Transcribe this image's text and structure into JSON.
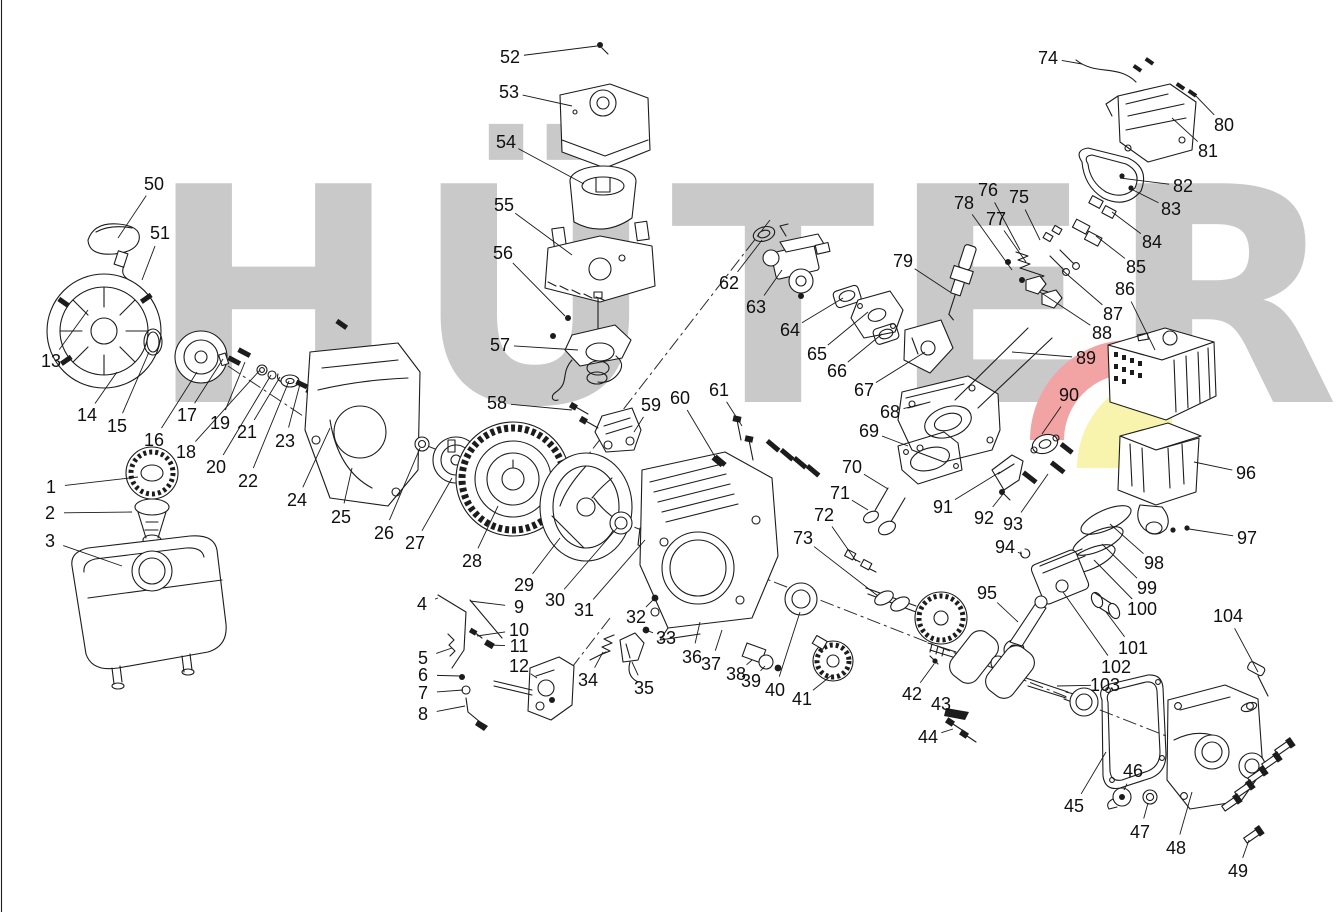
{
  "watermark": {
    "text": "HÜTER"
  },
  "colors": {
    "watermark_gray": "#c9c9c9",
    "logo_red": "#f2a3a3",
    "logo_yellow": "#f8f4ae",
    "line_ink": "#1c1c1c",
    "background": "#ffffff"
  },
  "callouts": [
    {
      "n": "1",
      "x": 51,
      "y": 487,
      "tx": 138,
      "ty": 477
    },
    {
      "n": "2",
      "x": 50,
      "y": 513,
      "tx": 132,
      "ty": 512
    },
    {
      "n": "3",
      "x": 50,
      "y": 541,
      "tx": 122,
      "ty": 566
    },
    {
      "n": "4",
      "x": 422,
      "y": 604,
      "tx": 438,
      "ty": 598
    },
    {
      "n": "5",
      "x": 423,
      "y": 658,
      "tx": 452,
      "ty": 648
    },
    {
      "n": "6",
      "x": 423,
      "y": 675,
      "tx": 460,
      "ty": 676
    },
    {
      "n": "7",
      "x": 423,
      "y": 693,
      "tx": 463,
      "ty": 690
    },
    {
      "n": "8",
      "x": 423,
      "y": 714,
      "tx": 465,
      "ty": 706
    },
    {
      "n": "9",
      "x": 519,
      "y": 607,
      "tx": 470,
      "ty": 601
    },
    {
      "n": "10",
      "x": 519,
      "y": 630,
      "tx": 477,
      "ty": 636
    },
    {
      "n": "11",
      "x": 519,
      "y": 646,
      "tx": 489,
      "ty": 645
    },
    {
      "n": "12",
      "x": 519,
      "y": 666,
      "tx": 537,
      "ty": 678
    },
    {
      "n": "13",
      "x": 51,
      "y": 361,
      "tx": 88,
      "ty": 310
    },
    {
      "n": "14",
      "x": 87,
      "y": 415,
      "tx": 117,
      "ty": 372
    },
    {
      "n": "15",
      "x": 117,
      "y": 426,
      "tx": 149,
      "ty": 352
    },
    {
      "n": "16",
      "x": 154,
      "y": 440,
      "tx": 197,
      "ty": 372
    },
    {
      "n": "17",
      "x": 187,
      "y": 415,
      "tx": 223,
      "ty": 359
    },
    {
      "n": "18",
      "x": 186,
      "y": 452,
      "tx": 260,
      "ty": 370
    },
    {
      "n": "19",
      "x": 220,
      "y": 423,
      "tx": 245,
      "ty": 362
    },
    {
      "n": "20",
      "x": 216,
      "y": 467,
      "tx": 271,
      "ty": 375
    },
    {
      "n": "21",
      "x": 247,
      "y": 432,
      "tx": 280,
      "ty": 377
    },
    {
      "n": "22",
      "x": 248,
      "y": 481,
      "tx": 289,
      "ty": 381
    },
    {
      "n": "23",
      "x": 285,
      "y": 441,
      "tx": 300,
      "ty": 384
    },
    {
      "n": "24",
      "x": 297,
      "y": 500,
      "tx": 330,
      "ty": 428
    },
    {
      "n": "25",
      "x": 341,
      "y": 517,
      "tx": 352,
      "ty": 468
    },
    {
      "n": "26",
      "x": 384,
      "y": 533,
      "tx": 420,
      "ty": 448
    },
    {
      "n": "27",
      "x": 415,
      "y": 543,
      "tx": 452,
      "ty": 478
    },
    {
      "n": "28",
      "x": 472,
      "y": 561,
      "tx": 498,
      "ty": 506
    },
    {
      "n": "29",
      "x": 524,
      "y": 585,
      "tx": 560,
      "ty": 538
    },
    {
      "n": "30",
      "x": 555,
      "y": 600,
      "tx": 617,
      "ty": 528
    },
    {
      "n": "31",
      "x": 584,
      "y": 610,
      "tx": 645,
      "ty": 540
    },
    {
      "n": "32",
      "x": 636,
      "y": 617,
      "tx": 655,
      "ty": 598
    },
    {
      "n": "33",
      "x": 666,
      "y": 638,
      "tx": 646,
      "ty": 630
    },
    {
      "n": "34",
      "x": 588,
      "y": 680,
      "tx": 603,
      "ty": 652
    },
    {
      "n": "35",
      "x": 644,
      "y": 688,
      "tx": 632,
      "ty": 662
    },
    {
      "n": "36",
      "x": 692,
      "y": 657,
      "tx": 700,
      "ty": 622
    },
    {
      "n": "37",
      "x": 711,
      "y": 664,
      "tx": 722,
      "ty": 630
    },
    {
      "n": "38",
      "x": 736,
      "y": 674,
      "tx": 752,
      "ty": 660
    },
    {
      "n": "39",
      "x": 751,
      "y": 681,
      "tx": 765,
      "ty": 666
    },
    {
      "n": "40",
      "x": 775,
      "y": 690,
      "tx": 800,
      "ty": 612
    },
    {
      "n": "41",
      "x": 802,
      "y": 699,
      "tx": 832,
      "ty": 675
    },
    {
      "n": "42",
      "x": 912,
      "y": 694,
      "tx": 934,
      "ty": 664
    },
    {
      "n": "43",
      "x": 941,
      "y": 704,
      "tx": 950,
      "ty": 712
    },
    {
      "n": "44",
      "x": 928,
      "y": 737,
      "tx": 953,
      "ty": 729
    },
    {
      "n": "45",
      "x": 1074,
      "y": 806,
      "tx": 1106,
      "ty": 752
    },
    {
      "n": "46",
      "x": 1133,
      "y": 771,
      "tx": 1124,
      "ty": 790
    },
    {
      "n": "47",
      "x": 1140,
      "y": 832,
      "tx": 1148,
      "ty": 803
    },
    {
      "n": "48",
      "x": 1176,
      "y": 848,
      "tx": 1192,
      "ty": 792
    },
    {
      "n": "49",
      "x": 1238,
      "y": 871,
      "tx": 1249,
      "ty": 840
    },
    {
      "n": "50",
      "x": 154,
      "y": 184,
      "tx": 118,
      "ty": 238
    },
    {
      "n": "51",
      "x": 160,
      "y": 233,
      "tx": 142,
      "ty": 280
    },
    {
      "n": "52",
      "x": 510,
      "y": 57,
      "tx": 597,
      "ty": 46
    },
    {
      "n": "53",
      "x": 509,
      "y": 92,
      "tx": 572,
      "ty": 106
    },
    {
      "n": "54",
      "x": 506,
      "y": 142,
      "tx": 584,
      "ty": 184
    },
    {
      "n": "55",
      "x": 504,
      "y": 205,
      "tx": 572,
      "ty": 255
    },
    {
      "n": "56",
      "x": 503,
      "y": 253,
      "tx": 565,
      "ty": 316
    },
    {
      "n": "57",
      "x": 500,
      "y": 345,
      "tx": 578,
      "ty": 350
    },
    {
      "n": "58",
      "x": 497,
      "y": 403,
      "tx": 572,
      "ty": 410
    },
    {
      "n": "59",
      "x": 651,
      "y": 405,
      "tx": 634,
      "ty": 432
    },
    {
      "n": "60",
      "x": 680,
      "y": 398,
      "tx": 717,
      "ty": 460
    },
    {
      "n": "61",
      "x": 719,
      "y": 390,
      "tx": 742,
      "ty": 426
    },
    {
      "n": "62",
      "x": 729,
      "y": 283,
      "tx": 762,
      "ty": 240
    },
    {
      "n": "63",
      "x": 756,
      "y": 307,
      "tx": 782,
      "ty": 270
    },
    {
      "n": "64",
      "x": 790,
      "y": 330,
      "tx": 843,
      "ty": 298
    },
    {
      "n": "65",
      "x": 817,
      "y": 354,
      "tx": 868,
      "ty": 312
    },
    {
      "n": "66",
      "x": 837,
      "y": 371,
      "tx": 882,
      "ty": 334
    },
    {
      "n": "67",
      "x": 864,
      "y": 390,
      "tx": 925,
      "ty": 352
    },
    {
      "n": "68",
      "x": 890,
      "y": 412,
      "tx": 922,
      "ty": 404
    },
    {
      "n": "69",
      "x": 869,
      "y": 431,
      "tx": 908,
      "ty": 446
    },
    {
      "n": "70",
      "x": 852,
      "y": 467,
      "tx": 888,
      "ty": 489
    },
    {
      "n": "71",
      "x": 840,
      "y": 493,
      "tx": 868,
      "ty": 510
    },
    {
      "n": "72",
      "x": 824,
      "y": 515,
      "tx": 856,
      "ty": 561
    },
    {
      "n": "73",
      "x": 803,
      "y": 538,
      "tx": 878,
      "ty": 596
    },
    {
      "n": "74",
      "x": 1048,
      "y": 58,
      "tx": 1082,
      "ty": 64
    },
    {
      "n": "75",
      "x": 1019,
      "y": 197,
      "tx": 1040,
      "ty": 240
    },
    {
      "n": "76",
      "x": 988,
      "y": 190,
      "tx": 1020,
      "ty": 250
    },
    {
      "n": "77",
      "x": 996,
      "y": 219,
      "tx": 1026,
      "ty": 262
    },
    {
      "n": "78",
      "x": 964,
      "y": 203,
      "tx": 1012,
      "ty": 270
    },
    {
      "n": "79",
      "x": 903,
      "y": 261,
      "tx": 950,
      "ty": 292
    },
    {
      "n": "80",
      "x": 1224,
      "y": 125,
      "tx": 1194,
      "ty": 94
    },
    {
      "n": "81",
      "x": 1208,
      "y": 151,
      "tx": 1172,
      "ty": 118
    },
    {
      "n": "82",
      "x": 1183,
      "y": 186,
      "tx": 1120,
      "ty": 178
    },
    {
      "n": "83",
      "x": 1171,
      "y": 209,
      "tx": 1133,
      "ty": 190
    },
    {
      "n": "84",
      "x": 1152,
      "y": 242,
      "tx": 1112,
      "ty": 212
    },
    {
      "n": "85",
      "x": 1136,
      "y": 267,
      "tx": 1096,
      "ty": 236
    },
    {
      "n": "86",
      "x": 1125,
      "y": 289,
      "tx": 1155,
      "ty": 350
    },
    {
      "n": "87",
      "x": 1113,
      "y": 314,
      "tx": 1062,
      "ty": 270
    },
    {
      "n": "88",
      "x": 1102,
      "y": 333,
      "tx": 1040,
      "ty": 292
    },
    {
      "n": "89",
      "x": 1086,
      "y": 358,
      "tx": 1012,
      "ty": 352
    },
    {
      "n": "90",
      "x": 1069,
      "y": 395,
      "tx": 1042,
      "ty": 434
    },
    {
      "n": "91",
      "x": 943,
      "y": 507,
      "tx": 1000,
      "ty": 472
    },
    {
      "n": "92",
      "x": 984,
      "y": 518,
      "tx": 1003,
      "ty": 494
    },
    {
      "n": "93",
      "x": 1013,
      "y": 524,
      "tx": 1048,
      "ty": 474
    },
    {
      "n": "94",
      "x": 1005,
      "y": 547,
      "tx": 1022,
      "ty": 554
    },
    {
      "n": "95",
      "x": 987,
      "y": 593,
      "tx": 1018,
      "ty": 622
    },
    {
      "n": "96",
      "x": 1246,
      "y": 473,
      "tx": 1194,
      "ty": 462
    },
    {
      "n": "97",
      "x": 1247,
      "y": 538,
      "tx": 1189,
      "ty": 529
    },
    {
      "n": "98",
      "x": 1154,
      "y": 563,
      "tx": 1110,
      "ty": 524
    },
    {
      "n": "99",
      "x": 1147,
      "y": 588,
      "tx": 1102,
      "ty": 544
    },
    {
      "n": "100",
      "x": 1142,
      "y": 609,
      "tx": 1094,
      "ty": 560
    },
    {
      "n": "101",
      "x": 1133,
      "y": 648,
      "tx": 1106,
      "ty": 612
    },
    {
      "n": "102",
      "x": 1116,
      "y": 667,
      "tx": 1063,
      "ty": 592
    },
    {
      "n": "103",
      "x": 1105,
      "y": 685,
      "tx": 1057,
      "ty": 686
    },
    {
      "n": "104",
      "x": 1228,
      "y": 616,
      "tx": 1258,
      "ty": 672
    }
  ]
}
